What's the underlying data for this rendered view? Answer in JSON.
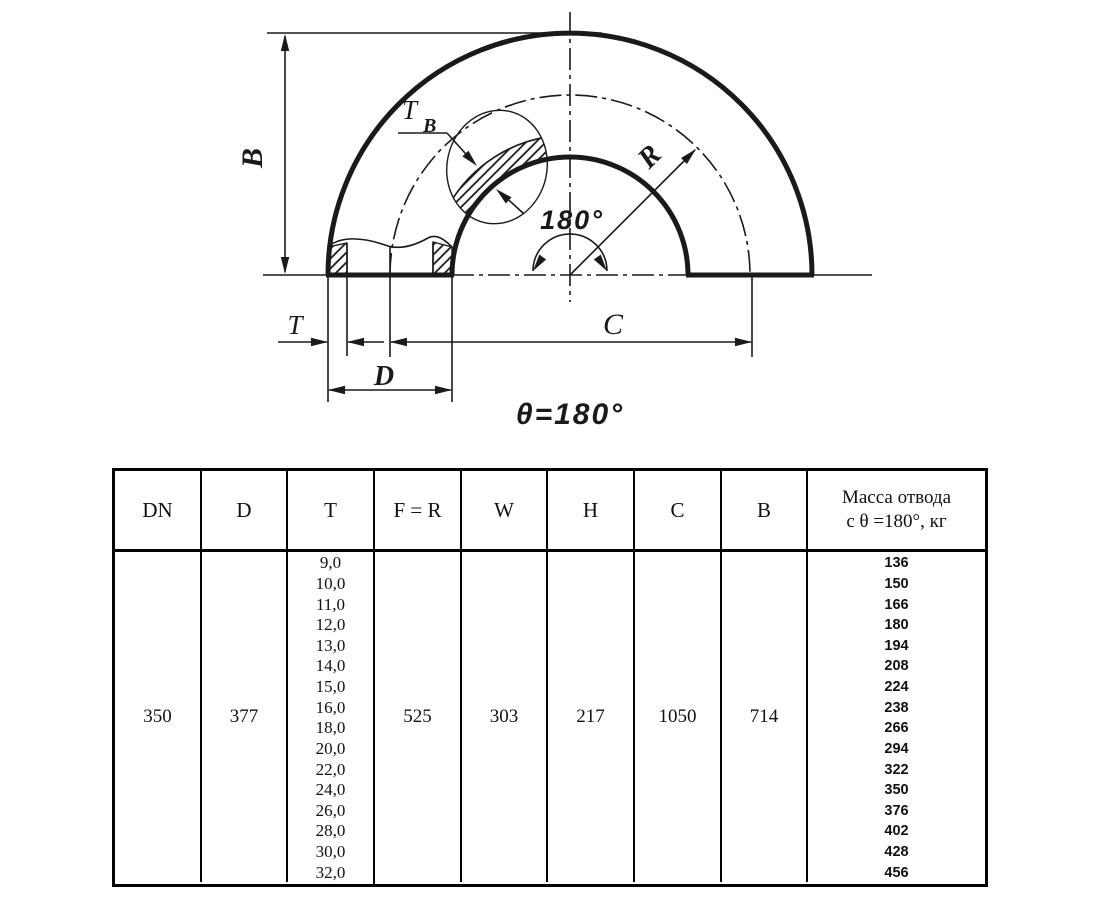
{
  "drawing": {
    "labels": {
      "b": "B",
      "tb_main": "T",
      "tb_sub": "B",
      "r": "R",
      "angle": "180°",
      "t": "T",
      "d": "D",
      "c": "C",
      "theta": "θ=180°"
    }
  },
  "table": {
    "headers": {
      "dn": "DN",
      "d": "D",
      "t": "T",
      "fr": "F = R",
      "w": "W",
      "h": "H",
      "c": "C",
      "b": "B",
      "mass_line1": "Масса отвода",
      "mass_line2": "с θ =180°, кг"
    },
    "row": {
      "dn": "350",
      "d": "377",
      "fr": "525",
      "w": "303",
      "h": "217",
      "c": "1050",
      "b": "714",
      "t_values": [
        "9,0",
        "10,0",
        "11,0",
        "12,0",
        "13,0",
        "14,0",
        "15,0",
        "16,0",
        "18,0",
        "20,0",
        "22,0",
        "24,0",
        "26,0",
        "28,0",
        "30,0",
        "32,0"
      ],
      "mass_values": [
        "136",
        "150",
        "166",
        "180",
        "194",
        "208",
        "224",
        "238",
        "266",
        "294",
        "322",
        "350",
        "376",
        "402",
        "428",
        "456"
      ]
    }
  }
}
